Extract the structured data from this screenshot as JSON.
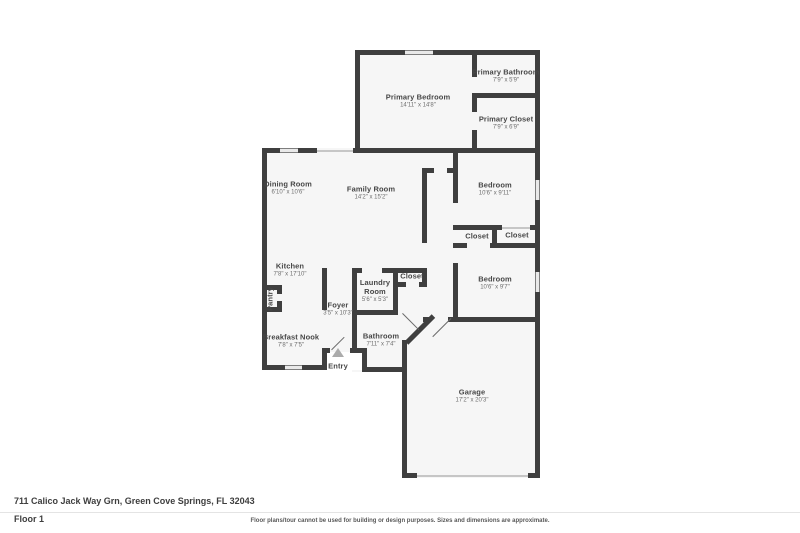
{
  "meta": {
    "address": "711 Calico Jack Way Grn, Green Cove Springs, FL 32043",
    "floor_label": "Floor 1",
    "disclaimer": "Floor plans/tour cannot be used for building or design purposes. Sizes and dimensions are approximate."
  },
  "colors": {
    "wall": "#3f3f3f",
    "floor": "#f6f6f6",
    "label": "#474747",
    "dims": "#6e6e6e"
  },
  "rooms": [
    {
      "name": "Primary Bedroom",
      "dims": "14'11\" x 14'8\""
    },
    {
      "name": "Primary Bathroom",
      "dims": "7'9\" x 5'9\""
    },
    {
      "name": "Primary Closet",
      "dims": "7'9\" x 6'9\""
    },
    {
      "name": "Dining Room",
      "dims": "6'10\" x 10'6\""
    },
    {
      "name": "Family Room",
      "dims": "14'2\" x 15'2\""
    },
    {
      "name": "Bedroom",
      "dims": "10'6\" x 9'11\""
    },
    {
      "name": "Closet",
      "dims": ""
    },
    {
      "name": "Closet",
      "dims": ""
    },
    {
      "name": "Bedroom",
      "dims": "10'6\" x 9'7\""
    },
    {
      "name": "Kitchen",
      "dims": "7'8\" x 17'10\""
    },
    {
      "name": "Pantry",
      "dims": ""
    },
    {
      "name": "Foyer",
      "dims": "3'5\" x 10'3\""
    },
    {
      "name": "Laundry Room",
      "dims": "5'6\" x 5'3\""
    },
    {
      "name": "Closet",
      "dims": ""
    },
    {
      "name": "Breakfast Nook",
      "dims": "7'8\" x 7'5\""
    },
    {
      "name": "Bathroom",
      "dims": "7'11\" x 7'4\""
    },
    {
      "name": "Entry",
      "dims": ""
    },
    {
      "name": "Garage",
      "dims": "17'2\" x 20'3\""
    }
  ]
}
